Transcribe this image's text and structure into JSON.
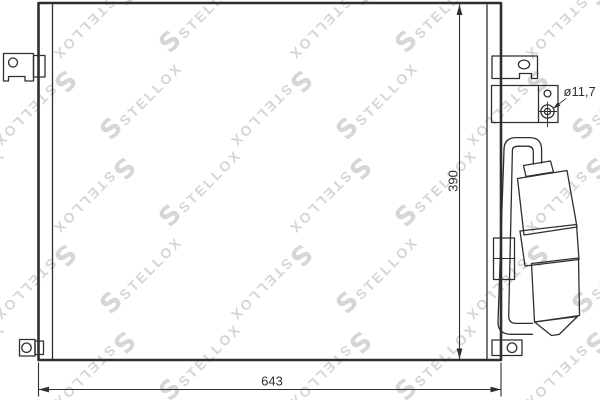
{
  "watermark": {
    "text": "STELLOX",
    "logo_letter": "S"
  },
  "labels": {
    "width": "643",
    "height": "390",
    "diameter": "ø11,7"
  },
  "colors": {
    "line": "#2f2f2f",
    "watermark": "#d6d6d6",
    "background": "#ffffff"
  }
}
